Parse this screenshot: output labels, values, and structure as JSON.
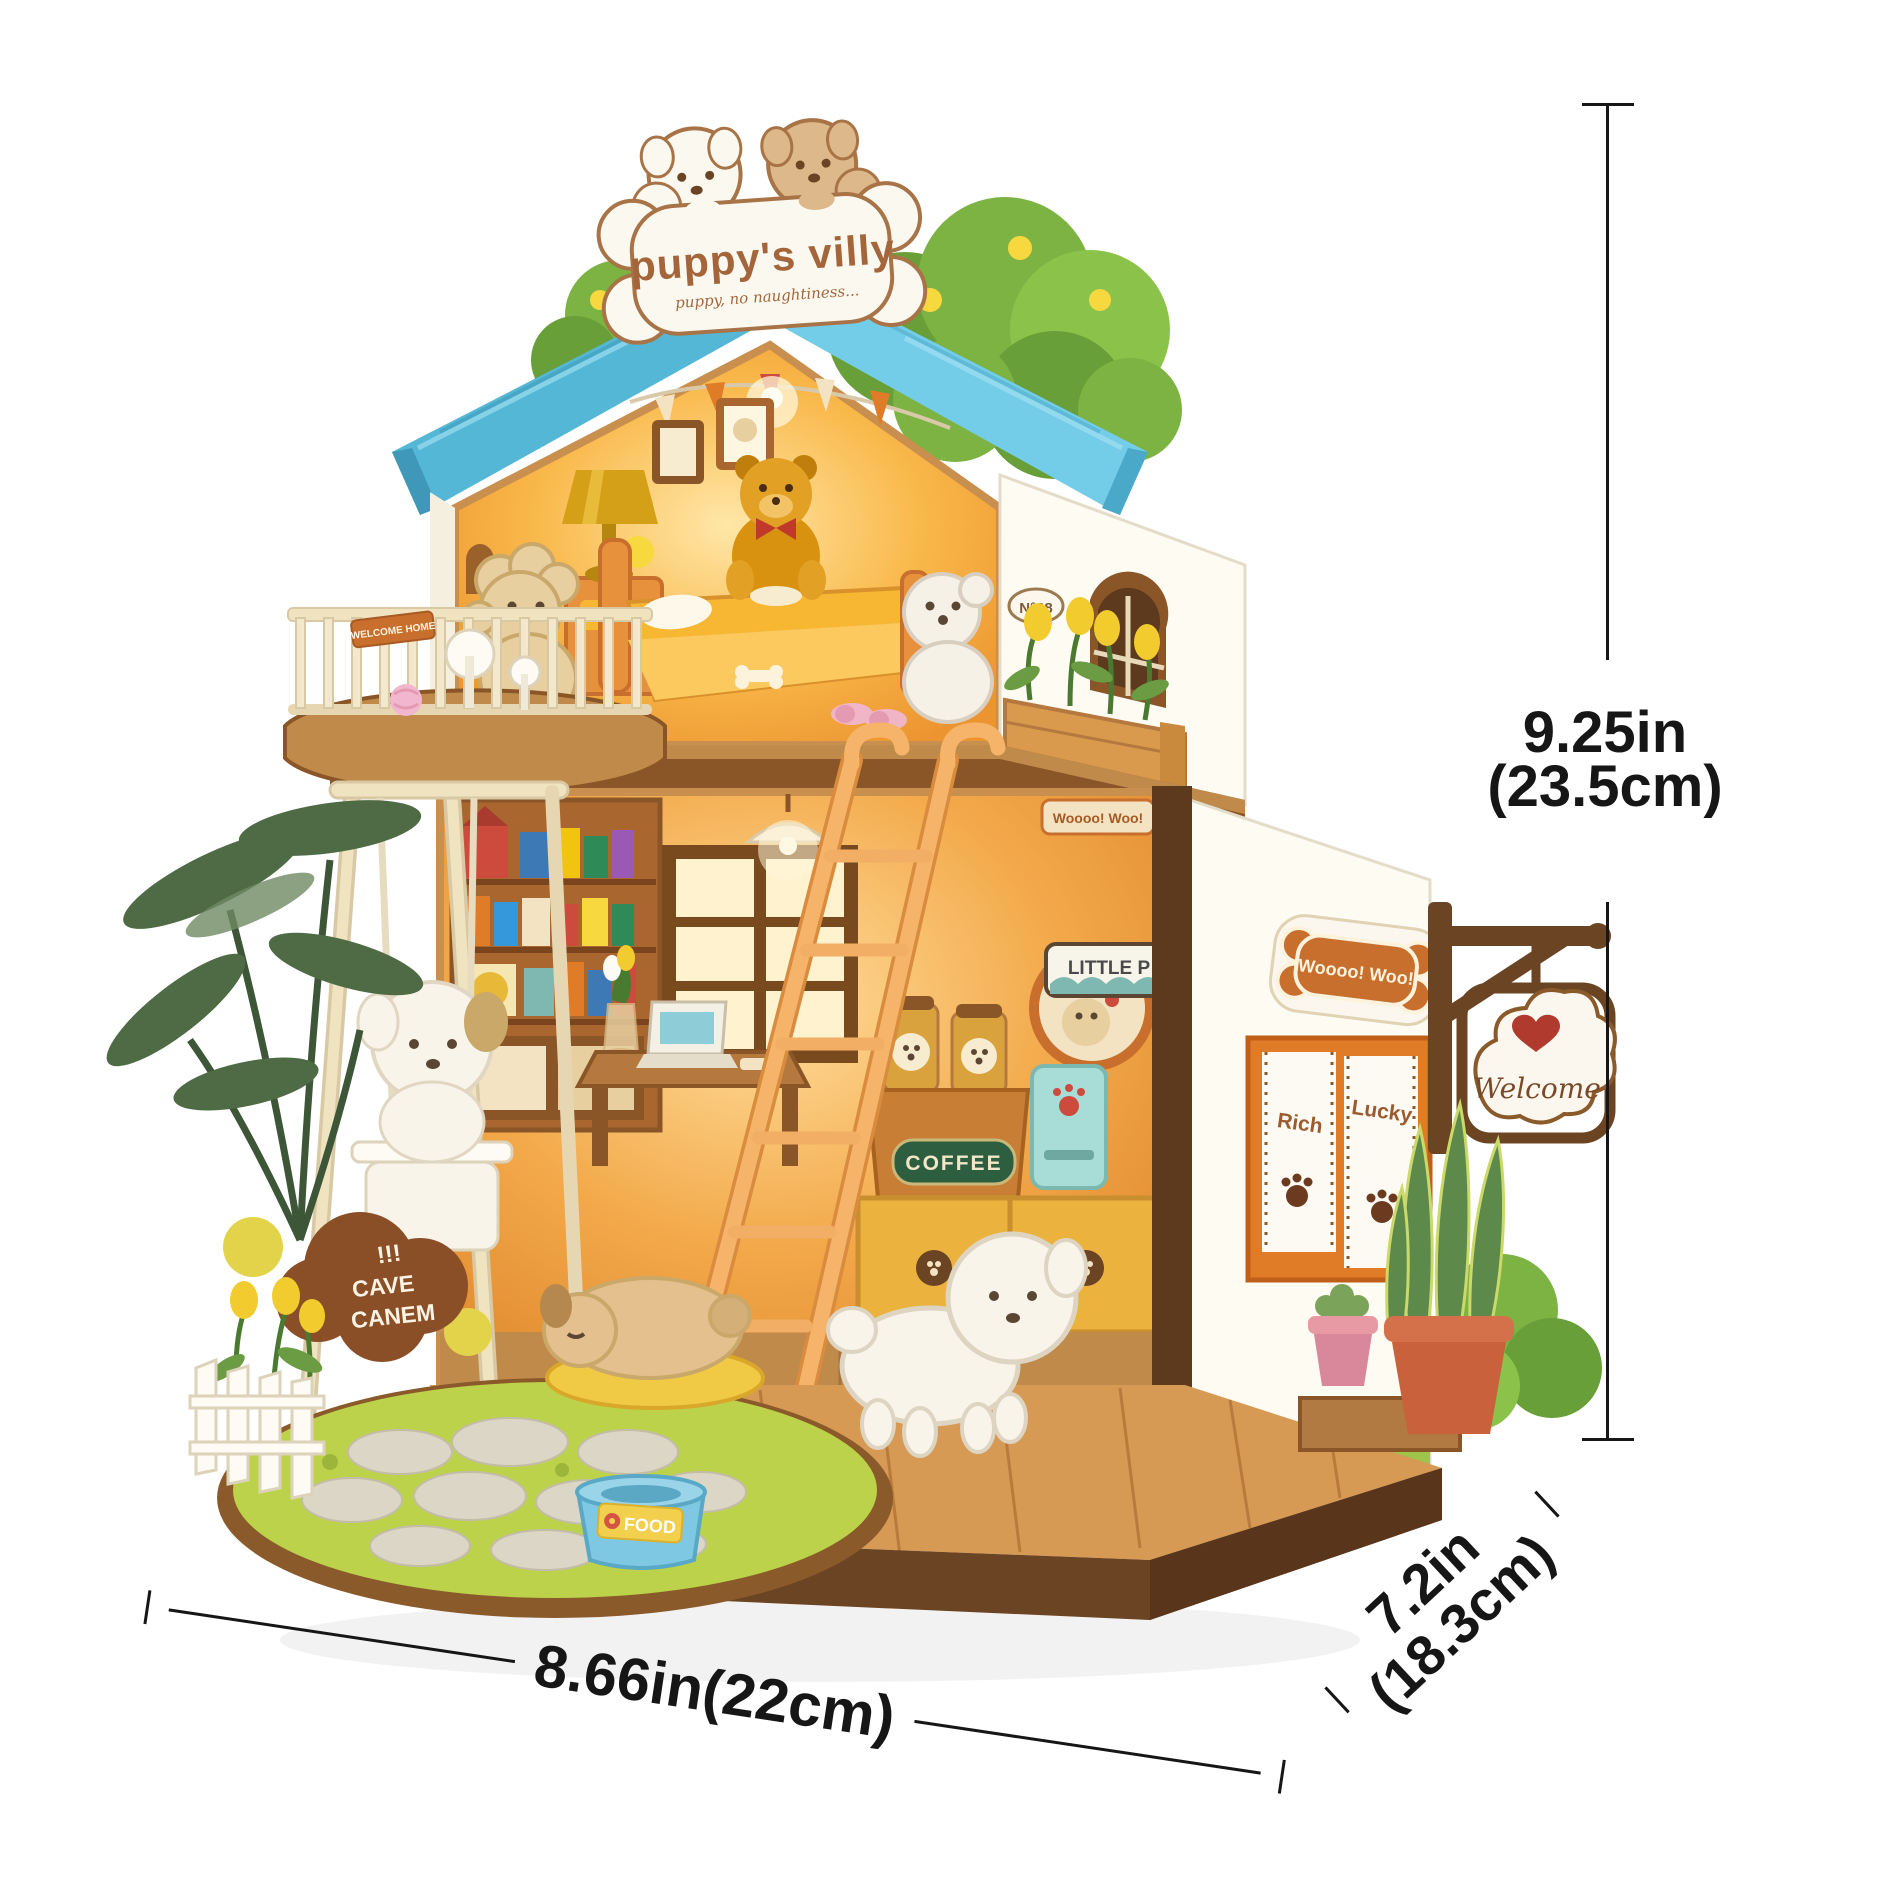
{
  "title_sign": {
    "title": "puppy's villy",
    "subtitle": "puppy, no naughtiness..."
  },
  "dimensions": {
    "height_in": "9.25in",
    "height_cm": "(23.5cm)",
    "width": "8.66in(22cm)",
    "depth_in": "7.2in",
    "depth_cm": "(18.3cm)"
  },
  "house_signs": {
    "bone_sign": "Woooo! Woo!",
    "welcome": "Welcome",
    "shop_board": "LITTLE P",
    "coffee": "COFFEE",
    "food": "FOOD",
    "beware_marks": "!!!",
    "beware_line1": "CAVE",
    "beware_line2": "CANEM",
    "house_number": "N°28",
    "curtain_left": "Rich",
    "curtain_right": "Lucky",
    "balcony_plank": "WELCOME HOME"
  },
  "palette": {
    "roof_blue": "#5fc0dd",
    "bush_green": "#7cb342",
    "glow_amber": "#f9b44c",
    "wood_brown": "#8a5527",
    "base_brown": "#5f3d1e",
    "accent_orange": "#e8913d",
    "dimension_ink": "#161616"
  }
}
